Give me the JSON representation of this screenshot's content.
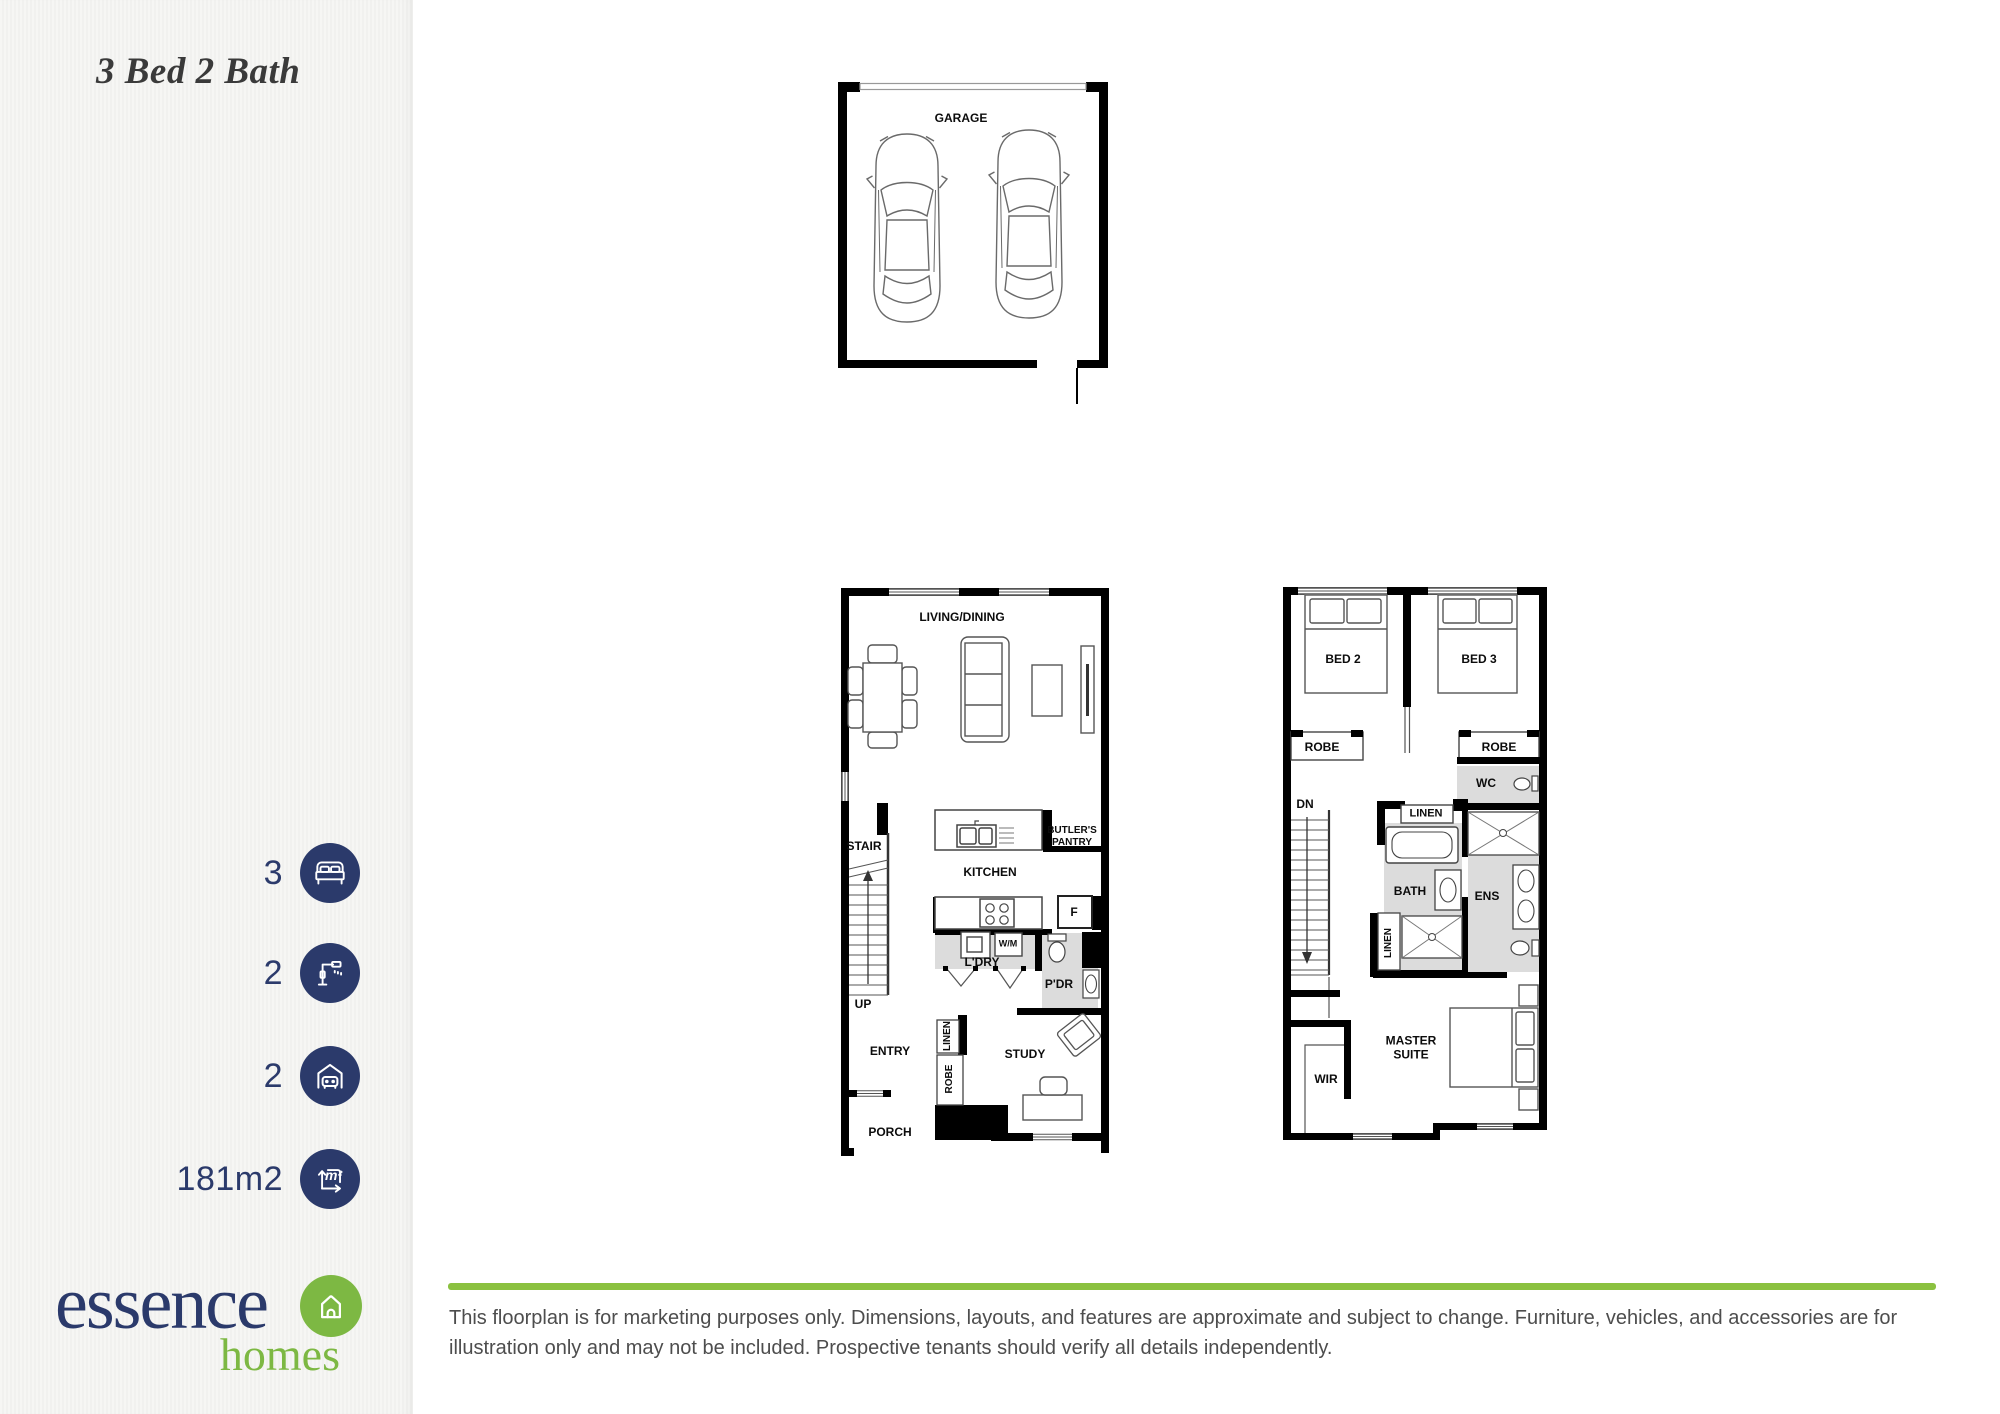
{
  "sidebar": {
    "title": "3 Bed 2 Bath",
    "specs": [
      {
        "value": "3",
        "icon": "bed-icon"
      },
      {
        "value": "2",
        "icon": "shower-icon"
      },
      {
        "value": "2",
        "icon": "car-garage-icon"
      },
      {
        "value": "181m2",
        "icon": "area-icon"
      }
    ],
    "area_icon_glyph": "m²",
    "logo": {
      "name": "essence",
      "suffix": "homes"
    }
  },
  "plans": {
    "garage": {
      "title": "GARAGE"
    },
    "ground": {
      "living_dining": "LIVING/DINING",
      "stair": "STAIR",
      "up": "UP",
      "kitchen": "KITCHEN",
      "butlers_pantry": "BUTLER'S PANTRY",
      "fridge": "F",
      "wm": "W/M",
      "laundry": "L'DRY",
      "powder": "P'DR",
      "entry": "ENTRY",
      "linen": "LINEN",
      "robe": "ROBE",
      "porch": "PORCH",
      "study": "STUDY"
    },
    "upper": {
      "bed2": "BED 2",
      "bed3": "BED 3",
      "robe_left": "ROBE",
      "robe_right": "ROBE",
      "wc": "WC",
      "dn": "DN",
      "linen_top": "LINEN",
      "bath": "BATH",
      "ens": "ENS",
      "linen_side": "LINEN",
      "wir": "WIR",
      "master": "MASTER SUITE"
    }
  },
  "footer": {
    "disclaimer": "This floorplan is for marketing purposes only. Dimensions, layouts, and features are approximate and subject to change. Furniture, vehicles, and accessories are for illustration only and may not be included. Prospective tenants should verify all details independently."
  },
  "colors": {
    "navy": "#2b3a6b",
    "green": "#8bc140"
  }
}
